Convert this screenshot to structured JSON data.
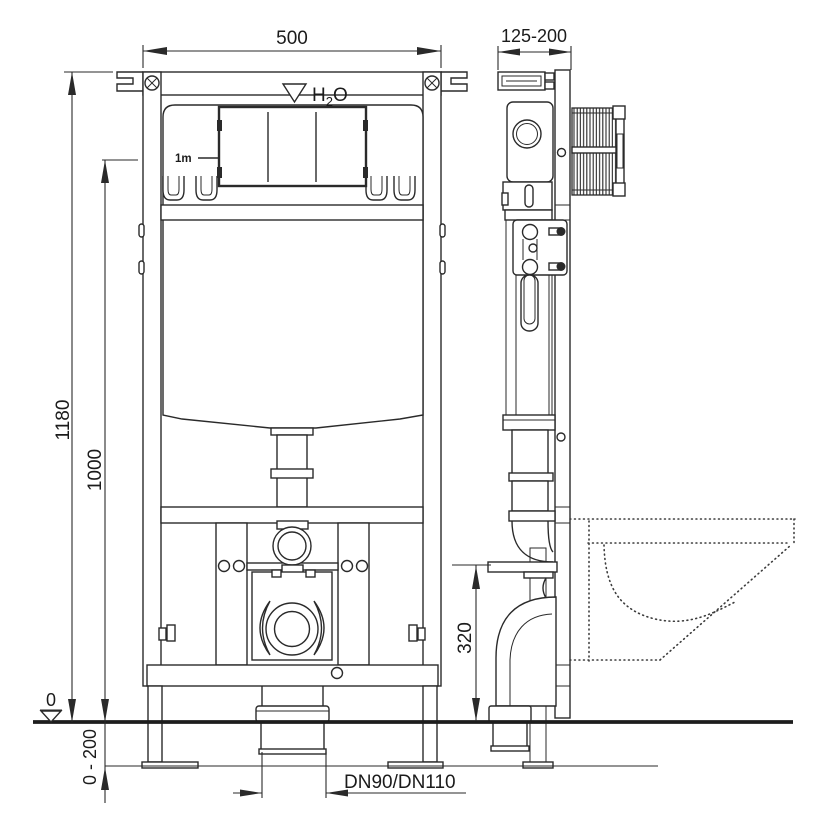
{
  "labels": {
    "width_front": "500",
    "depth_range": "125-200",
    "height_total": "1180",
    "height_1000": "1000",
    "outlet_height": "320",
    "floor_level_zero": "0",
    "floor_adjust_range": "0 - 200",
    "drain_size": "DN90/DN110",
    "water_level_mark": "1m",
    "water": {
      "h": "H",
      "sub": "2",
      "o": "O"
    }
  },
  "colors": {
    "line": "#2a2a2a",
    "background": "#ffffff"
  }
}
